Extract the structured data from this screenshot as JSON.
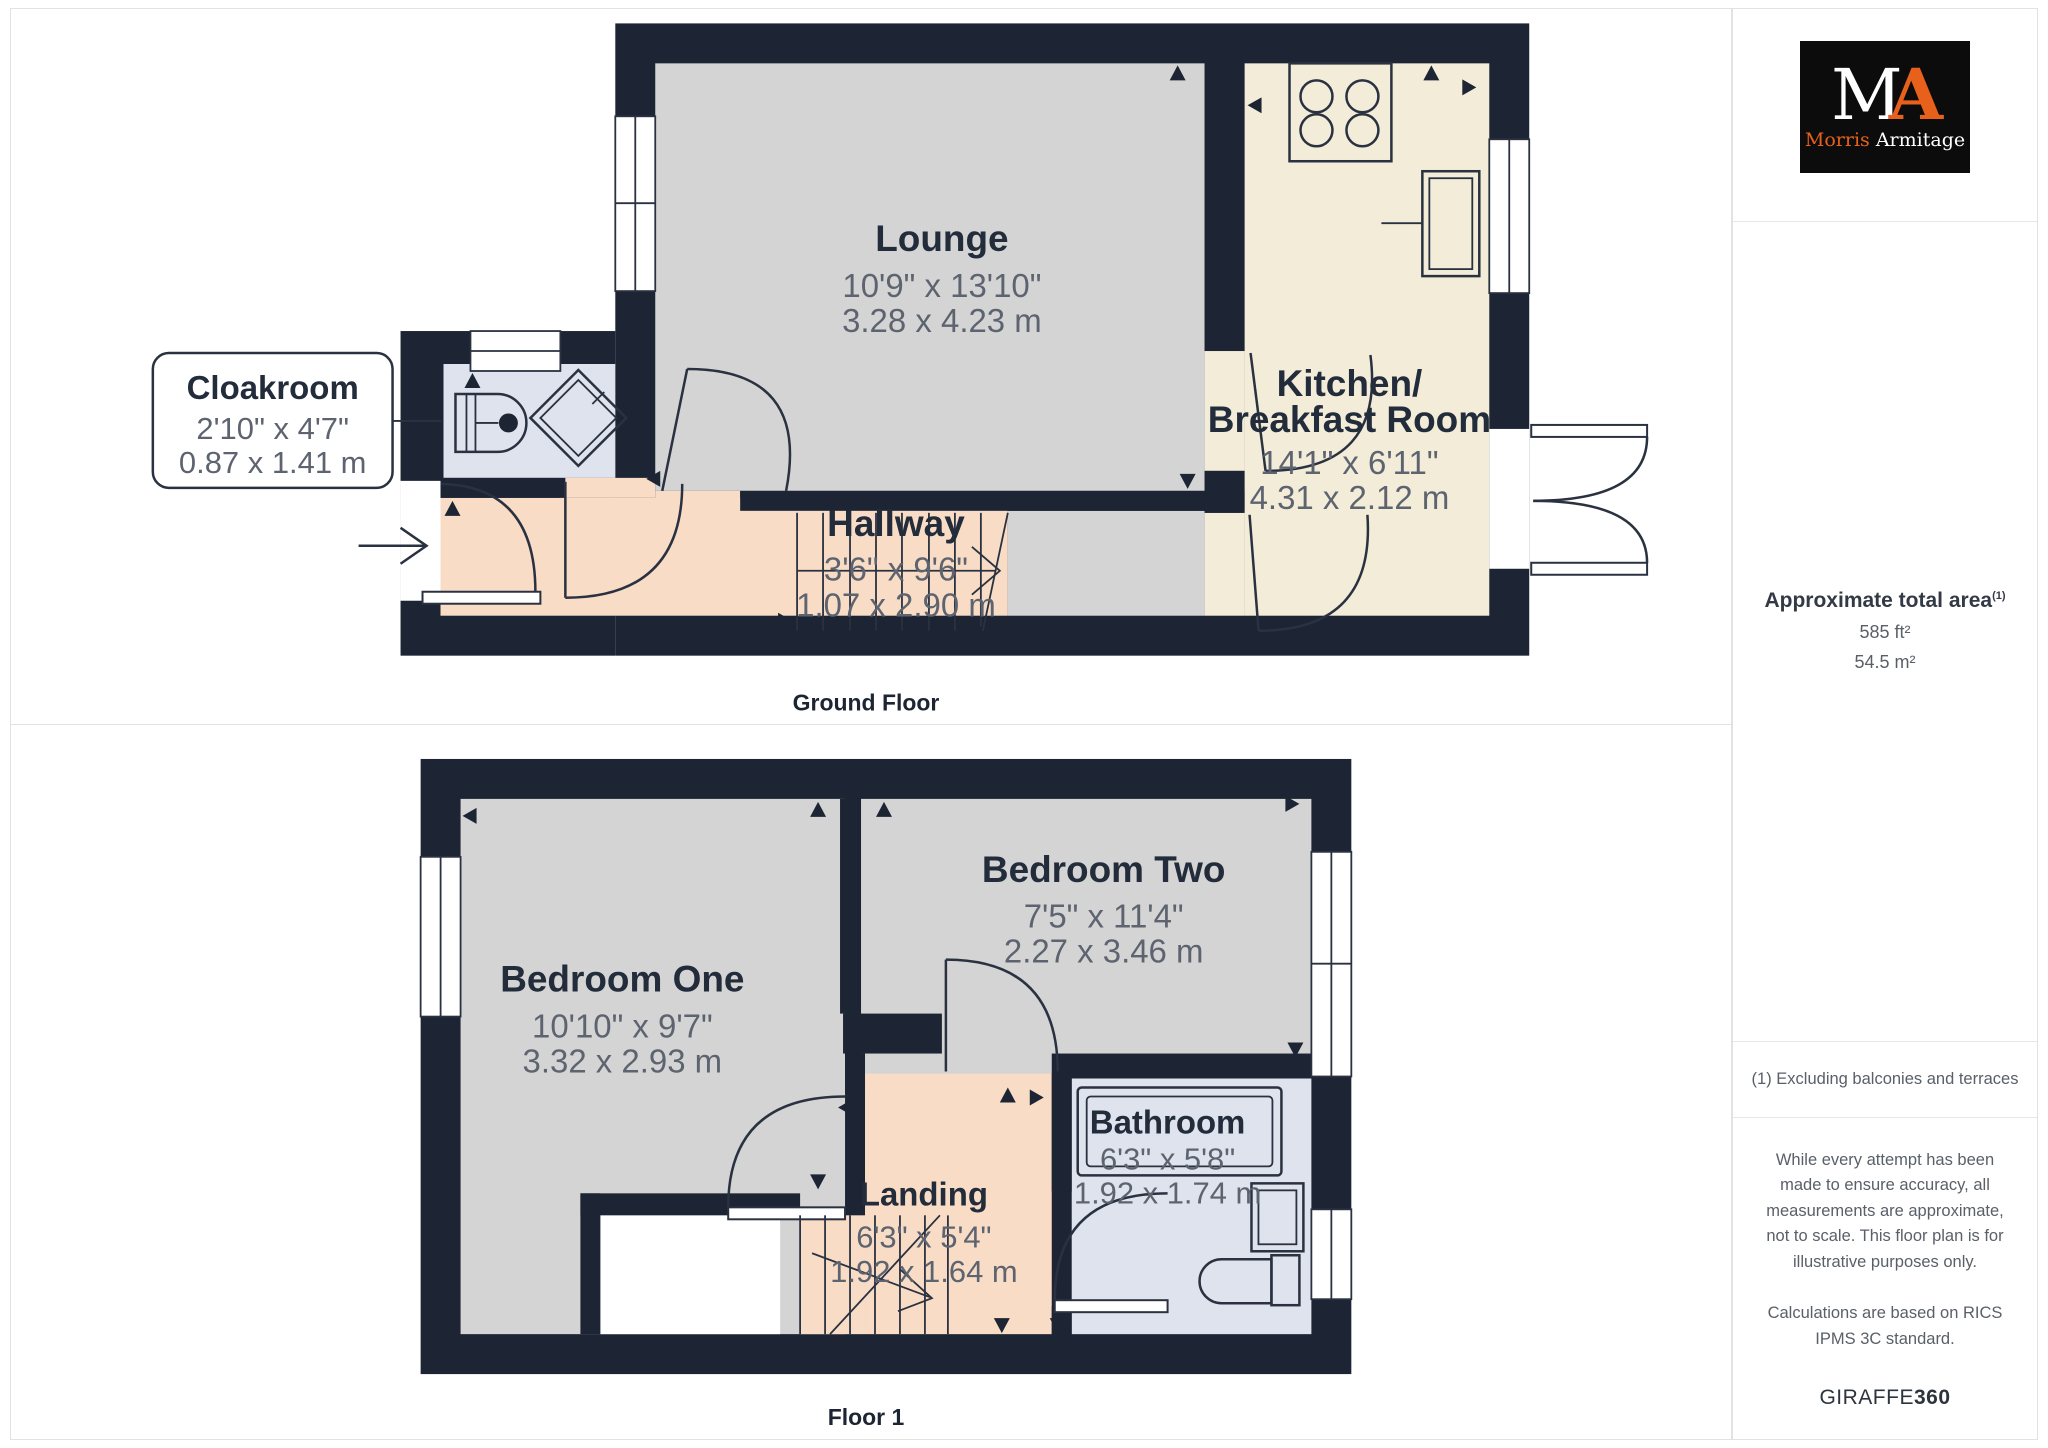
{
  "colors": {
    "wall": "#1d2534",
    "lounge_floor": "#d4d4d4",
    "kitchen_floor": "#f2ecd8",
    "hall_floor": "#f8dcc6",
    "wet_room_floor": "#dfe3ee",
    "accent_orange": "#e8611c"
  },
  "floors": [
    {
      "caption": "Ground Floor",
      "rooms": {
        "lounge": {
          "name": "Lounge",
          "imperial": "10'9\" x 13'10\"",
          "metric": "3.28 x 4.23 m"
        },
        "kitchen": {
          "name_line1": "Kitchen/",
          "name_line2": "Breakfast Room",
          "imperial": "14'1\" x 6'11\"",
          "metric": "4.31 x 2.12 m"
        },
        "cloakroom": {
          "name": "Cloakroom",
          "imperial": "2'10\" x 4'7\"",
          "metric": "0.87 x 1.41 m"
        },
        "hallway": {
          "name": "Hallway",
          "imperial": "3'6\" x 9'6\"",
          "metric": "1.07 x 2.90 m"
        }
      }
    },
    {
      "caption": "Floor 1",
      "rooms": {
        "bedroom_one": {
          "name": "Bedroom One",
          "imperial": "10'10\" x 9'7\"",
          "metric": "3.32 x 2.93 m"
        },
        "bedroom_two": {
          "name": "Bedroom Two",
          "imperial": "7'5\" x 11'4\"",
          "metric": "2.27 x 3.46 m"
        },
        "bathroom": {
          "name": "Bathroom",
          "imperial": "6'3\" x 5'8\"",
          "metric": "1.92 x 1.74 m"
        },
        "landing": {
          "name": "Landing",
          "imperial": "6'3\" x 5'4\"",
          "metric": "1.92 x 1.64 m"
        }
      }
    }
  ],
  "sidebar": {
    "logo": {
      "initial_m": "M",
      "initial_a": "A",
      "name_part1": "Morris",
      "name_part2": "Armitage"
    },
    "area": {
      "title": "Approximate total area",
      "superscript": "(1)",
      "imperial": "585 ft²",
      "metric": "54.5 m²"
    },
    "note": "(1) Excluding balconies and terraces",
    "disclaimer1": "While every attempt has been made to ensure accuracy, all measurements are approximate, not to scale. This floor plan is for illustrative purposes only.",
    "disclaimer2": "Calculations are based on RICS IPMS 3C standard.",
    "brand": {
      "part1": "GIRAFFE",
      "part2": "360"
    }
  }
}
